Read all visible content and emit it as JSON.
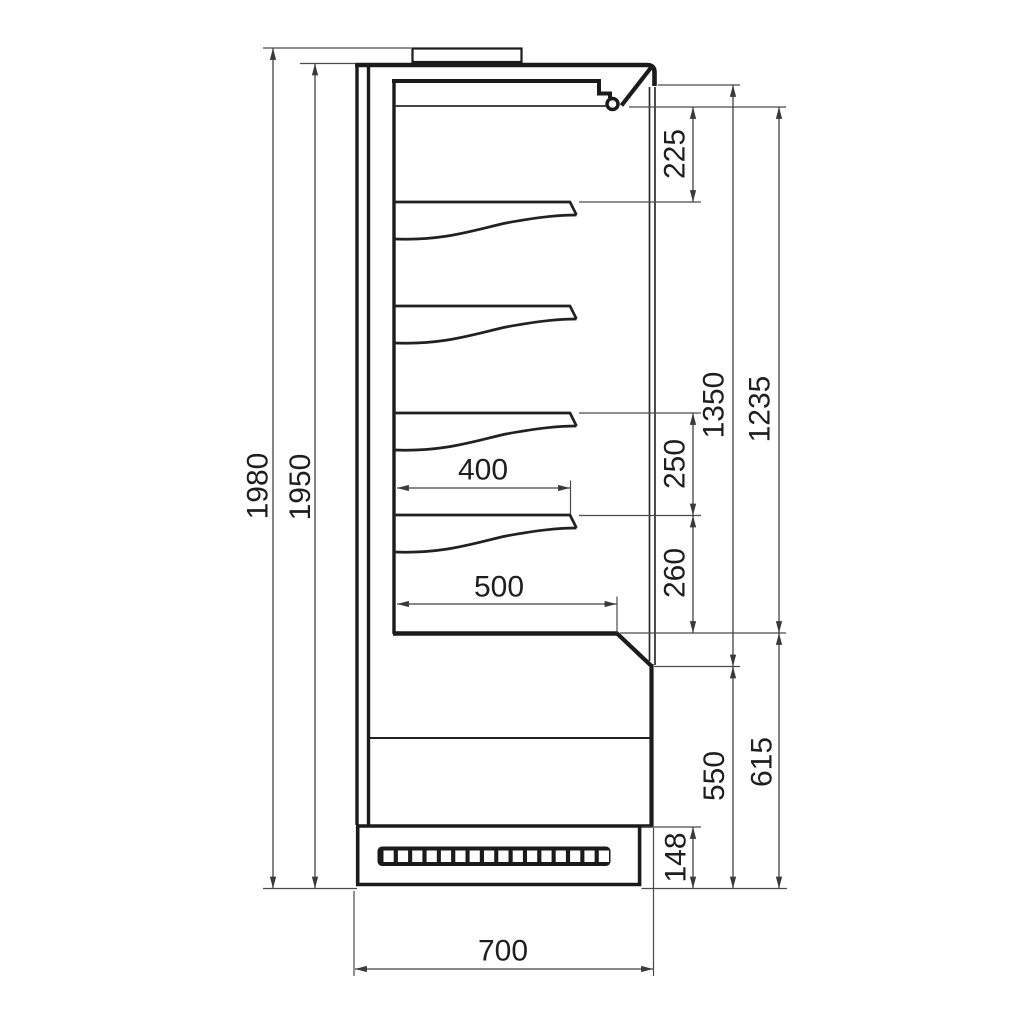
{
  "diagram": {
    "dims": {
      "overall_height": "1980",
      "body_height": "1950",
      "canopy_to_top_shelf": "225",
      "opening_height_outer": "1350",
      "opening_height_inner": "1235",
      "shelf_spacing": "250",
      "bottom_shelf_to_deck": "260",
      "shelf_depth": "400",
      "deck_depth": "500",
      "lower_front_height": "550",
      "base_section_height": "615",
      "plinth_height": "148",
      "overall_depth": "700"
    }
  }
}
